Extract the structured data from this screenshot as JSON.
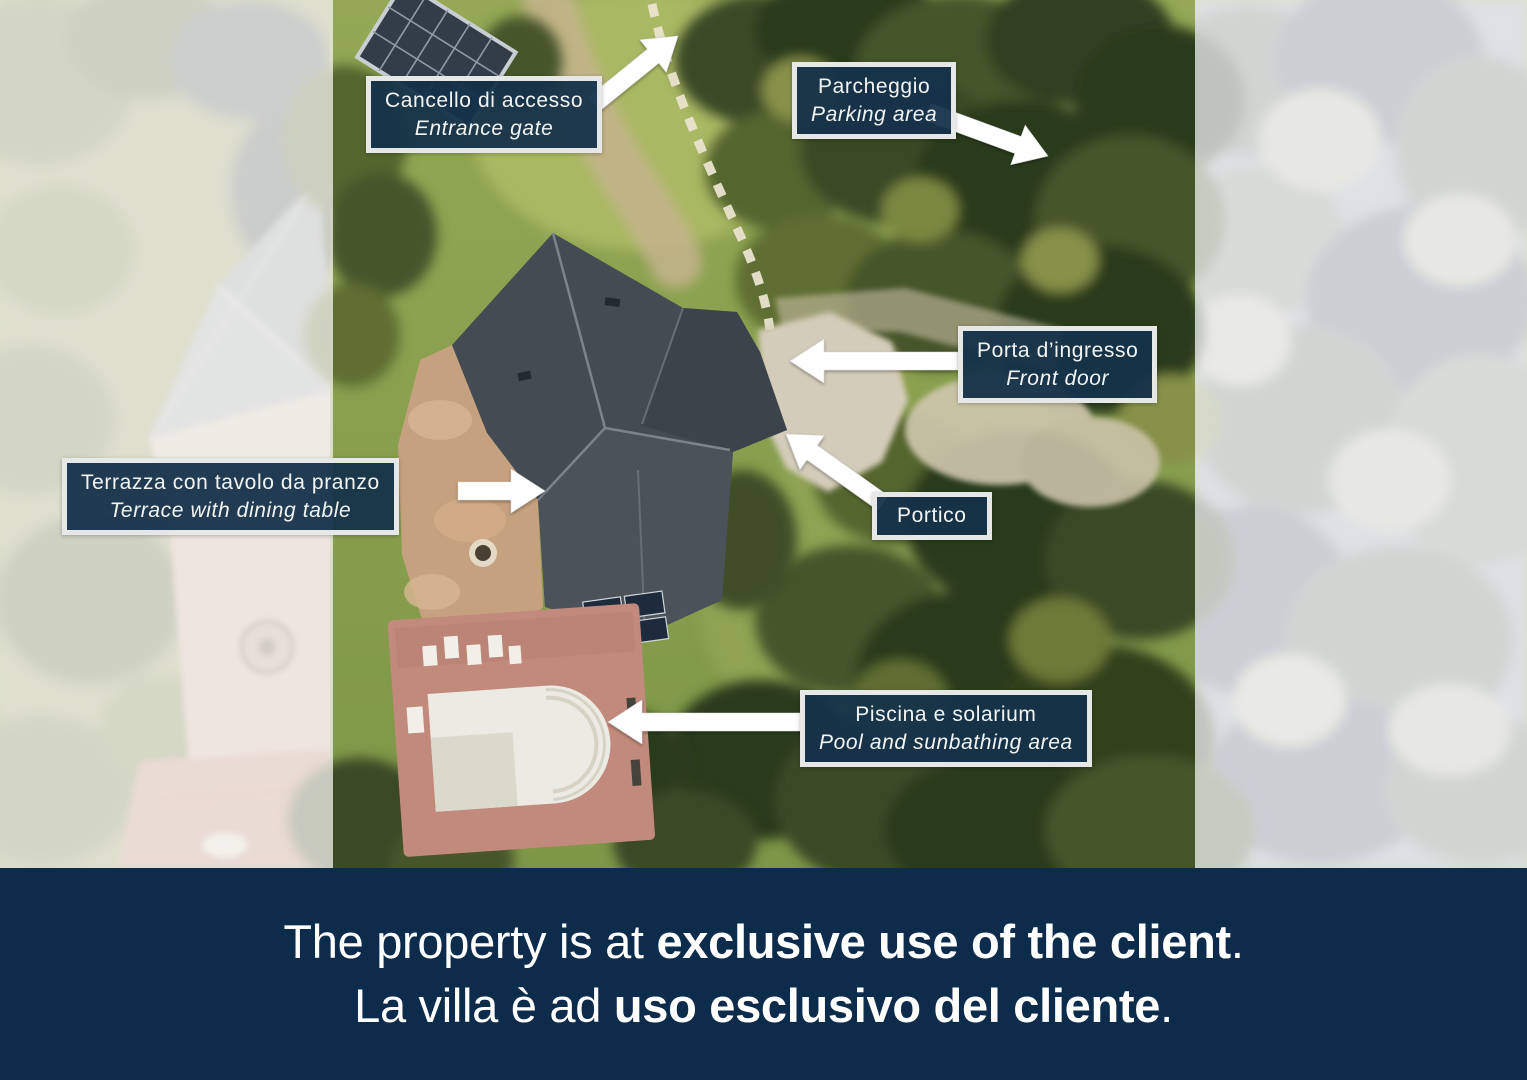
{
  "labels": {
    "entrance_gate": {
      "it": "Cancello di accesso",
      "en": "Entrance gate"
    },
    "parking": {
      "it": "Parcheggio",
      "en": "Parking area"
    },
    "front_door": {
      "it": "Porta d’ingresso",
      "en": "Front door"
    },
    "terrace": {
      "it": "Terrazza con tavolo da pranzo",
      "en": "Terrace with dining table"
    },
    "portico": {
      "it": "Portico"
    },
    "pool": {
      "it": "Piscina e solarium",
      "en": "Pool and sunbathing area"
    }
  },
  "banner": {
    "line1_prefix": "The property is at ",
    "line1_bold": "exclusive use of the client",
    "line1_suffix": ".",
    "line2_prefix": "La villa è ad ",
    "line2_bold": "uso esclusivo del cliente",
    "line2_suffix": "."
  },
  "colors": {
    "label_background": "#15314a",
    "label_border": "#f7f7f4",
    "label_text": "#f2f4f2",
    "banner_background": "#0d2b4b",
    "banner_text": "#ffffff",
    "arrow": "#ffffff"
  }
}
